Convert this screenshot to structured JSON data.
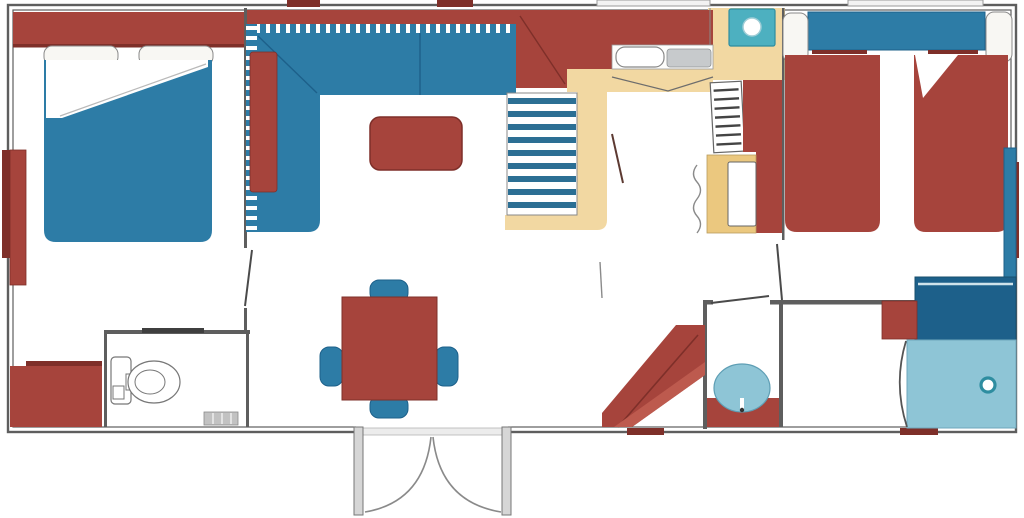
{
  "colors": {
    "wall": "#5e5e5e",
    "frame_gray": "#d6d6d6",
    "line_gray": "#8a8a8a",
    "hatch_gray": "#c2c2c2",
    "red": "#a6443c",
    "red_dark": "#7e2f29",
    "red_light": "#bd5a4e",
    "blue": "#2d7ca6",
    "blue_dark": "#1d608a",
    "blue_deep": "#2c6f94",
    "blue_light": "#8ec5d6",
    "teal": "#4db0c0",
    "teal_dark": "#2e8da0",
    "floor_yellow": "#f2d8a2",
    "counter_yellow": "#ebc87f",
    "appliance_gray": "#c7cacc",
    "pillow": "#f8f7f3",
    "white": "#ffffff"
  },
  "floorplan": {
    "type": "mobile-home top-down floor plan",
    "regions": [
      {
        "id": "master-bedroom",
        "furniture": [
          "double-bed",
          "headboard-wardrobe",
          "pillows",
          "side-wardrobe",
          "dresser"
        ]
      },
      {
        "id": "wc",
        "furniture": [
          "toilet",
          "door-threshold"
        ]
      },
      {
        "id": "living-room",
        "furniture": [
          "l-shaped-sofa",
          "chaise-cushion",
          "coffee-table",
          "dining-table",
          "dining-chairs-x4"
        ]
      },
      {
        "id": "stairs",
        "furniture": [
          "steps"
        ]
      },
      {
        "id": "kitchen",
        "furniture": [
          "counter",
          "sink",
          "drainer",
          "hob-unit",
          "fridge",
          "oven-cabinet",
          "accordion-door"
        ]
      },
      {
        "id": "twin-bedroom",
        "furniture": [
          "headboard-shelf",
          "pillows",
          "twin-bed-left",
          "twin-bed-right",
          "wardrobe"
        ]
      },
      {
        "id": "washroom",
        "furniture": [
          "vanity",
          "basin"
        ]
      },
      {
        "id": "shower-room",
        "furniture": [
          "shower-tray",
          "drain",
          "screen-arc",
          "shelf",
          "cabinet"
        ]
      },
      {
        "id": "entrance",
        "furniture": [
          "double-french-doors"
        ]
      },
      {
        "id": "hall",
        "furniture": [
          "angled-bench"
        ]
      }
    ],
    "windows": [
      "top-left-red-tab",
      "top-center-red-tab",
      "kitchen-top-window",
      "twin-bedroom-top-window",
      "left-wall-red-strip",
      "right-wall-red-strip",
      "bottom-red-marks"
    ]
  }
}
